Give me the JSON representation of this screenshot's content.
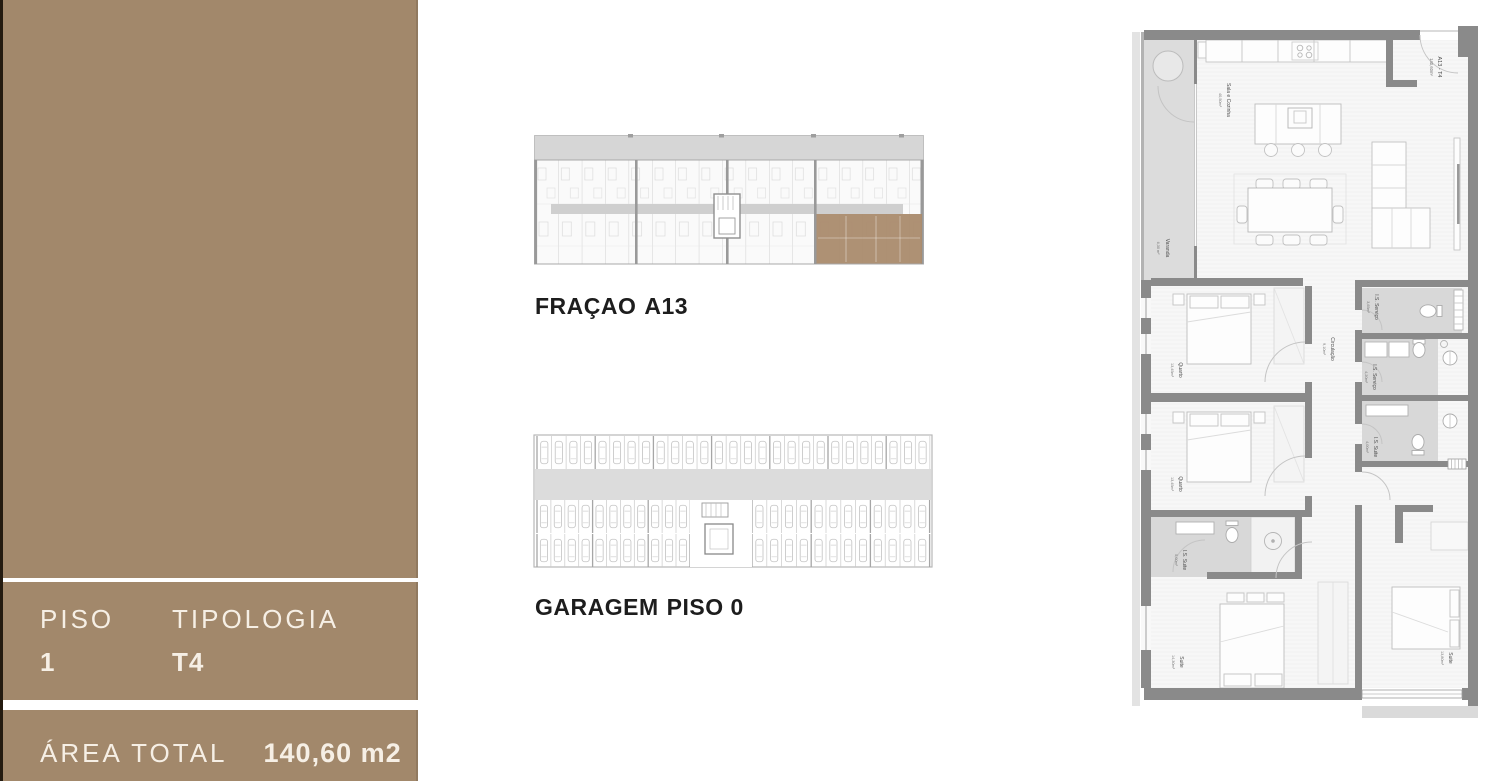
{
  "sidebar": {
    "panel_color": "#a2886b",
    "text_color": "#f6efe5",
    "floor": {
      "label": "PISO",
      "value": "1"
    },
    "typology": {
      "label": "TIPOLOGIA",
      "value": "T4"
    },
    "total_area": {
      "label": "ÁREA TOTAL",
      "value": "140,60 m2"
    }
  },
  "fraction_plan": {
    "title": "FRAÇAO",
    "highlight": "A13"
  },
  "garage_plan": {
    "title": "GARAGEM",
    "highlight": "PISO 0",
    "stalls_top": 27,
    "stalls_mid_left": 11,
    "stalls_mid_right": 12,
    "stalls_bottom_left": 11,
    "stalls_bottom_highlight": 2,
    "stalls_bottom_right": 12
  },
  "apartment_plan": {
    "unit": {
      "name": "A13 - T4",
      "area": "140,60m²"
    },
    "rooms": [
      {
        "name": "Sala e Cozinha",
        "area": "40,50m²"
      },
      {
        "name": "Varanda",
        "area": "6,30 m²"
      },
      {
        "name": "Quarto",
        "area": "13,45m²"
      },
      {
        "name": "Quarto",
        "area": "13,45m²"
      },
      {
        "name": "Circulação",
        "area": "9,10m²"
      },
      {
        "name": "I.S. Serviço",
        "area": "3,65m²"
      },
      {
        "name": "I.S. Serviço",
        "area": "4,20m²"
      },
      {
        "name": "I.S. Suite",
        "area": "4,00m²"
      },
      {
        "name": "I.S. Suite",
        "area": "5,00m²"
      },
      {
        "name": "Suite",
        "area": "14,30m²"
      },
      {
        "name": "Suite",
        "area": "13,80m²"
      }
    ]
  },
  "colors": {
    "highlight": "#aa8b6d",
    "wall": "#8a8a8a",
    "roof": "#d6d6d6",
    "bath_floor": "#d8d8d8",
    "lane": "#dcdcdc"
  }
}
